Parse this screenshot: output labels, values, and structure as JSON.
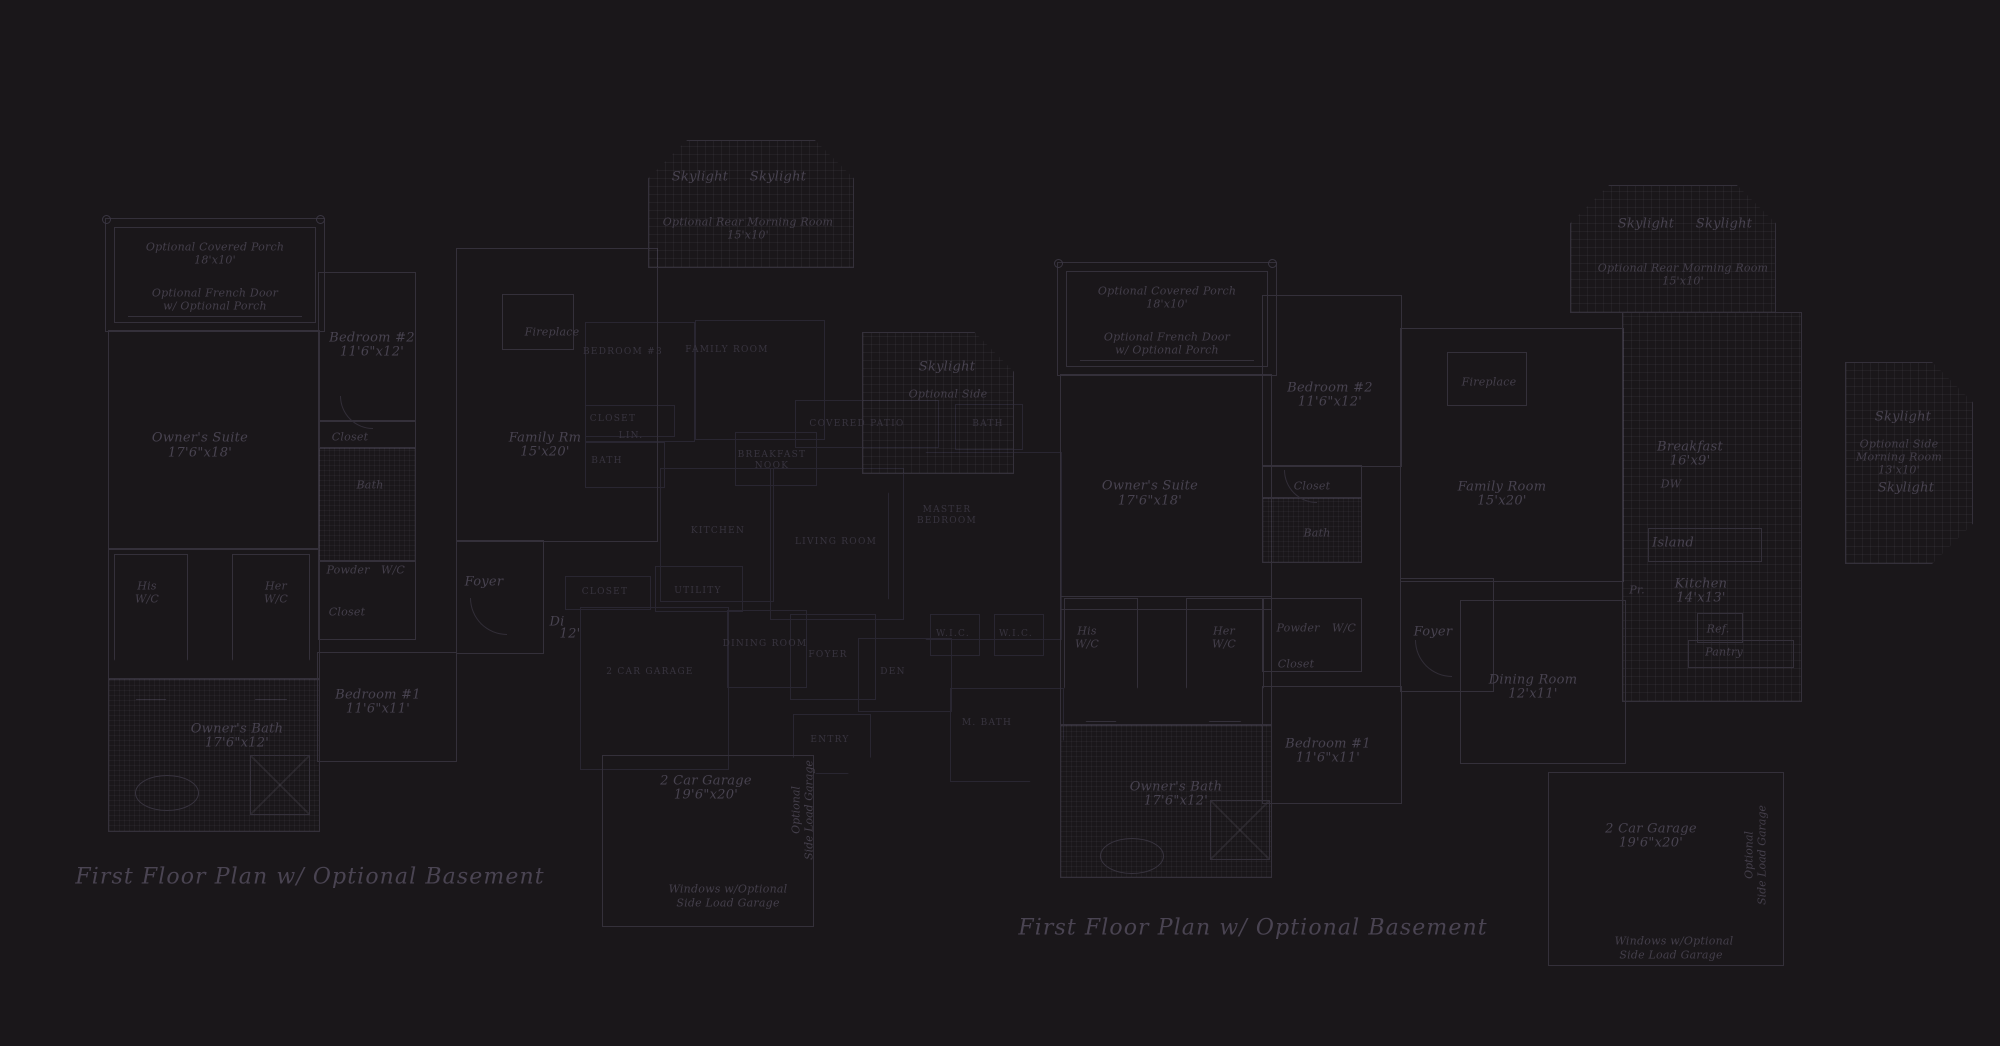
{
  "titles": {
    "left": "First Floor Plan  w/ Optional Basement",
    "right": "First Floor Plan  w/ Optional Basement"
  },
  "colors": {
    "background": "#1a171a",
    "linework": "#34303a",
    "linework_faint": "#292631",
    "label_text": "#484350",
    "title_text": "#4a4452"
  },
  "plans": [
    {
      "id": "left-plan",
      "labels": [
        {
          "t": "Optional Covered Porch",
          "x": 215,
          "y": 247,
          "c": "it-sm"
        },
        {
          "t": "18'x10'",
          "x": 215,
          "y": 260,
          "c": "it-sm"
        },
        {
          "t": "Optional French Door",
          "x": 215,
          "y": 293,
          "c": "it-sm"
        },
        {
          "t": "w/ Optional Porch",
          "x": 215,
          "y": 306,
          "c": "it-sm"
        },
        {
          "t": "Owner's Suite",
          "x": 200,
          "y": 438,
          "c": "it"
        },
        {
          "t": "17'6\"x18'",
          "x": 200,
          "y": 453,
          "c": "it"
        },
        {
          "t": "Bedroom #2",
          "x": 372,
          "y": 338,
          "c": "it"
        },
        {
          "t": "11'6\"x12'",
          "x": 372,
          "y": 352,
          "c": "it"
        },
        {
          "t": "Closet",
          "x": 350,
          "y": 437,
          "c": "it-sm"
        },
        {
          "t": "Bath",
          "x": 370,
          "y": 485,
          "c": "it-sm"
        },
        {
          "t": "Skylight",
          "x": 700,
          "y": 177,
          "c": "it"
        },
        {
          "t": "Skylight",
          "x": 778,
          "y": 177,
          "c": "it"
        },
        {
          "t": "Optional Rear Morning Room",
          "x": 748,
          "y": 222,
          "c": "it-sm"
        },
        {
          "t": "15'x10'",
          "x": 748,
          "y": 235,
          "c": "it-sm"
        },
        {
          "t": "Fireplace",
          "x": 552,
          "y": 332,
          "c": "it-sm"
        },
        {
          "t": "Family Rm",
          "x": 545,
          "y": 438,
          "c": "it"
        },
        {
          "t": "15'x20'",
          "x": 545,
          "y": 452,
          "c": "it"
        },
        {
          "t": "Skylight",
          "x": 947,
          "y": 367,
          "c": "it"
        },
        {
          "t": "Optional Side",
          "x": 948,
          "y": 394,
          "c": "it-sm"
        },
        {
          "t": "His",
          "x": 147,
          "y": 586,
          "c": "it-sm"
        },
        {
          "t": "W/C",
          "x": 147,
          "y": 599,
          "c": "it-sm"
        },
        {
          "t": "Her",
          "x": 276,
          "y": 586,
          "c": "it-sm"
        },
        {
          "t": "W/C",
          "x": 276,
          "y": 599,
          "c": "it-sm"
        },
        {
          "t": "Powder",
          "x": 348,
          "y": 570,
          "c": "it-sm"
        },
        {
          "t": "W/C",
          "x": 393,
          "y": 570,
          "c": "it-sm"
        },
        {
          "t": "Closet",
          "x": 347,
          "y": 612,
          "c": "it-sm"
        },
        {
          "t": "Foyer",
          "x": 484,
          "y": 582,
          "c": "it"
        },
        {
          "t": "Di",
          "x": 557,
          "y": 622,
          "c": "it"
        },
        {
          "t": "12'",
          "x": 570,
          "y": 634,
          "c": "it"
        },
        {
          "t": "Owner's Bath",
          "x": 237,
          "y": 729,
          "c": "it"
        },
        {
          "t": "17'6\"x12'",
          "x": 237,
          "y": 743,
          "c": "it"
        },
        {
          "t": "Bedroom #1",
          "x": 378,
          "y": 695,
          "c": "it"
        },
        {
          "t": "11'6\"x11'",
          "x": 378,
          "y": 709,
          "c": "it"
        },
        {
          "t": "2 Car Garage",
          "x": 706,
          "y": 781,
          "c": "it"
        },
        {
          "t": "19'6\"x20'",
          "x": 706,
          "y": 795,
          "c": "it"
        },
        {
          "t": "Optional",
          "x": 796,
          "y": 810,
          "c": "vt"
        },
        {
          "t": "Side Load Garage",
          "x": 809,
          "y": 810,
          "c": "vt"
        },
        {
          "t": "Windows w/Optional",
          "x": 728,
          "y": 889,
          "c": "it-sm"
        },
        {
          "t": "Side Load Garage",
          "x": 728,
          "y": 903,
          "c": "it-sm"
        }
      ]
    },
    {
      "id": "center-plan",
      "labels": [
        {
          "t": "BEDROOM #3",
          "x": 623,
          "y": 352,
          "c": "caps"
        },
        {
          "t": "FAMILY ROOM",
          "x": 727,
          "y": 350,
          "c": "caps"
        },
        {
          "t": "CLOSET",
          "x": 613,
          "y": 419,
          "c": "caps"
        },
        {
          "t": "LIN.",
          "x": 631,
          "y": 436,
          "c": "caps"
        },
        {
          "t": "BATH",
          "x": 607,
          "y": 461,
          "c": "caps"
        },
        {
          "t": "COVERED PATIO",
          "x": 857,
          "y": 424,
          "c": "caps"
        },
        {
          "t": "BATH",
          "x": 988,
          "y": 424,
          "c": "caps"
        },
        {
          "t": "BREAKFAST",
          "x": 772,
          "y": 455,
          "c": "caps"
        },
        {
          "t": "NOOK",
          "x": 772,
          "y": 466,
          "c": "caps"
        },
        {
          "t": "KITCHEN",
          "x": 718,
          "y": 531,
          "c": "caps"
        },
        {
          "t": "LIVING ROOM",
          "x": 836,
          "y": 542,
          "c": "caps"
        },
        {
          "t": "MASTER",
          "x": 947,
          "y": 510,
          "c": "caps"
        },
        {
          "t": "BEDROOM",
          "x": 947,
          "y": 521,
          "c": "caps"
        },
        {
          "t": "CLOSET",
          "x": 605,
          "y": 592,
          "c": "caps"
        },
        {
          "t": "UTILITY",
          "x": 698,
          "y": 591,
          "c": "caps"
        },
        {
          "t": "2 CAR GARAGE",
          "x": 650,
          "y": 672,
          "c": "caps"
        },
        {
          "t": "DINING ROOM",
          "x": 765,
          "y": 644,
          "c": "caps"
        },
        {
          "t": "FOYER",
          "x": 828,
          "y": 655,
          "c": "caps"
        },
        {
          "t": "DEN",
          "x": 893,
          "y": 672,
          "c": "caps"
        },
        {
          "t": "W.I.C.",
          "x": 953,
          "y": 634,
          "c": "caps"
        },
        {
          "t": "W.I.C.",
          "x": 1016,
          "y": 634,
          "c": "caps"
        },
        {
          "t": "M. BATH",
          "x": 987,
          "y": 723,
          "c": "caps"
        },
        {
          "t": "ENTRY",
          "x": 830,
          "y": 740,
          "c": "caps"
        }
      ]
    },
    {
      "id": "right-plan",
      "labels": [
        {
          "t": "Optional Covered Porch",
          "x": 1167,
          "y": 291,
          "c": "it-sm"
        },
        {
          "t": "18'x10'",
          "x": 1167,
          "y": 304,
          "c": "it-sm"
        },
        {
          "t": "Optional French Door",
          "x": 1167,
          "y": 337,
          "c": "it-sm"
        },
        {
          "t": "w/ Optional Porch",
          "x": 1167,
          "y": 350,
          "c": "it-sm"
        },
        {
          "t": "Owner's Suite",
          "x": 1150,
          "y": 486,
          "c": "it"
        },
        {
          "t": "17'6\"x18'",
          "x": 1150,
          "y": 501,
          "c": "it"
        },
        {
          "t": "Bedroom #2",
          "x": 1330,
          "y": 388,
          "c": "it"
        },
        {
          "t": "11'6\"x12'",
          "x": 1330,
          "y": 402,
          "c": "it"
        },
        {
          "t": "Closet",
          "x": 1312,
          "y": 486,
          "c": "it-sm"
        },
        {
          "t": "Bath",
          "x": 1317,
          "y": 533,
          "c": "it-sm"
        },
        {
          "t": "Fireplace",
          "x": 1489,
          "y": 382,
          "c": "it-sm"
        },
        {
          "t": "Family Room",
          "x": 1502,
          "y": 487,
          "c": "it"
        },
        {
          "t": "15'x20'",
          "x": 1502,
          "y": 501,
          "c": "it"
        },
        {
          "t": "Skylight",
          "x": 1646,
          "y": 224,
          "c": "it"
        },
        {
          "t": "Skylight",
          "x": 1724,
          "y": 224,
          "c": "it"
        },
        {
          "t": "Optional Rear Morning Room",
          "x": 1683,
          "y": 268,
          "c": "it-sm"
        },
        {
          "t": "15'x10'",
          "x": 1683,
          "y": 281,
          "c": "it-sm"
        },
        {
          "t": "Breakfast",
          "x": 1690,
          "y": 447,
          "c": "it"
        },
        {
          "t": "16'x9'",
          "x": 1690,
          "y": 461,
          "c": "it"
        },
        {
          "t": "DW",
          "x": 1671,
          "y": 484,
          "c": "it-sm"
        },
        {
          "t": "Island",
          "x": 1673,
          "y": 543,
          "c": "it"
        },
        {
          "t": "Kitchen",
          "x": 1701,
          "y": 584,
          "c": "it"
        },
        {
          "t": "14'x13'",
          "x": 1701,
          "y": 598,
          "c": "it"
        },
        {
          "t": "Pr.",
          "x": 1637,
          "y": 590,
          "c": "it-sm"
        },
        {
          "t": "Ref.",
          "x": 1718,
          "y": 629,
          "c": "it-sm"
        },
        {
          "t": "Pantry",
          "x": 1724,
          "y": 652,
          "c": "it-sm"
        },
        {
          "t": "Skylight",
          "x": 1903,
          "y": 417,
          "c": "it"
        },
        {
          "t": "Optional Side",
          "x": 1899,
          "y": 444,
          "c": "it-sm"
        },
        {
          "t": "Morning Room",
          "x": 1899,
          "y": 457,
          "c": "it-sm"
        },
        {
          "t": "13'x10'",
          "x": 1899,
          "y": 470,
          "c": "it-sm"
        },
        {
          "t": "Skylight",
          "x": 1906,
          "y": 488,
          "c": "it"
        },
        {
          "t": "Dining Room",
          "x": 1533,
          "y": 680,
          "c": "it"
        },
        {
          "t": "12'x11'",
          "x": 1533,
          "y": 694,
          "c": "it"
        },
        {
          "t": "Foyer",
          "x": 1433,
          "y": 632,
          "c": "it"
        },
        {
          "t": "Powder",
          "x": 1298,
          "y": 628,
          "c": "it-sm"
        },
        {
          "t": "W/C",
          "x": 1344,
          "y": 628,
          "c": "it-sm"
        },
        {
          "t": "Closet",
          "x": 1296,
          "y": 664,
          "c": "it-sm"
        },
        {
          "t": "His",
          "x": 1087,
          "y": 631,
          "c": "it-sm"
        },
        {
          "t": "W/C",
          "x": 1087,
          "y": 644,
          "c": "it-sm"
        },
        {
          "t": "Her",
          "x": 1224,
          "y": 631,
          "c": "it-sm"
        },
        {
          "t": "W/C",
          "x": 1224,
          "y": 644,
          "c": "it-sm"
        },
        {
          "t": "Bedroom #1",
          "x": 1328,
          "y": 744,
          "c": "it"
        },
        {
          "t": "11'6\"x11'",
          "x": 1328,
          "y": 758,
          "c": "it"
        },
        {
          "t": "Owner's Bath",
          "x": 1176,
          "y": 787,
          "c": "it"
        },
        {
          "t": "17'6\"x12'",
          "x": 1176,
          "y": 801,
          "c": "it"
        },
        {
          "t": "2 Car Garage",
          "x": 1651,
          "y": 829,
          "c": "it"
        },
        {
          "t": "19'6\"x20'",
          "x": 1651,
          "y": 843,
          "c": "it"
        },
        {
          "t": "Optional",
          "x": 1749,
          "y": 855,
          "c": "vt"
        },
        {
          "t": "Side Load Garage",
          "x": 1762,
          "y": 855,
          "c": "vt"
        },
        {
          "t": "Windows w/Optional",
          "x": 1674,
          "y": 941,
          "c": "it-sm"
        },
        {
          "t": "Side Load Garage",
          "x": 1671,
          "y": 955,
          "c": "it-sm"
        }
      ]
    }
  ]
}
